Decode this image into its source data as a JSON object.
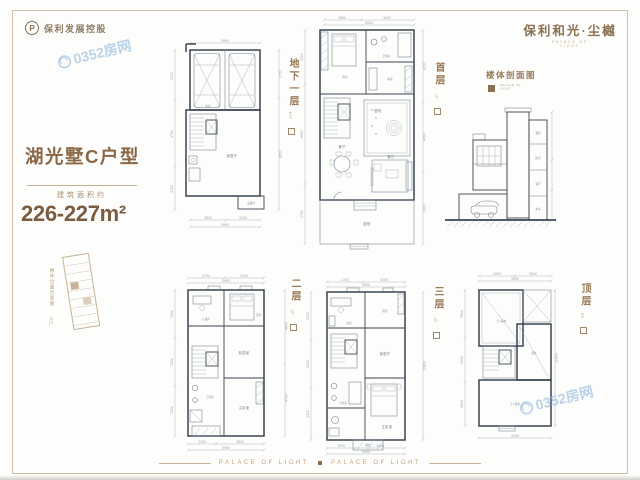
{
  "brand": {
    "logo_text": "保利发展控股",
    "logo_mark": "P",
    "name": "保利和光·尘樾",
    "name_sub": "PALACE OF LIGHT"
  },
  "unit": {
    "name": "湖光墅C户型",
    "area_label": "建筑面积约",
    "area_value": "226-227m²"
  },
  "locator": {
    "caption": "楼体位置示意图",
    "entry": "入户"
  },
  "watermark": {
    "text": "0352房网"
  },
  "footer": {
    "left": "PALACE OF LIGHT",
    "right": "PALACE OF LIGHT"
  },
  "section": {
    "label": "楼体剖面图",
    "sub1": "PALACE OF",
    "sub2": "LIGHT",
    "rooms": {
      "r1": "露台",
      "r2": "卧室",
      "r3": "客厅",
      "r4": "车库"
    }
  },
  "plans": {
    "b1": {
      "label": "地下一层",
      "tag": "B1F",
      "rooms": {
        "garage": "车库",
        "family": "家庭厅",
        "equip": "设备间"
      },
      "dims": {
        "top": "5900",
        "left1": "2150",
        "left2": "5750",
        "left3": "3300",
        "right1": "2150",
        "right2": "8850",
        "bottom1": "3650",
        "bottom2": "2250",
        "bottom": "5900"
      }
    },
    "f1": {
      "label": "首层",
      "tag": "1F",
      "rooms": {
        "bed": "卧室",
        "bath": "卫生间",
        "kitchen": "厨房",
        "court": "庭院",
        "dining": "餐厅",
        "living": "客厅",
        "yard": "庭院"
      },
      "dims": {
        "top1": "2600",
        "top2": "3400",
        "top": "6000",
        "left1": "3300",
        "left2": "6900",
        "left3": "2700",
        "right1": "4100",
        "right2": "4000",
        "right3": "2900",
        "bottom": "6000"
      }
    },
    "f2": {
      "label": "二层",
      "tag": "2F",
      "rooms": {
        "kid": "儿童房",
        "bed": "卧室",
        "sitting": "起居室",
        "master": "主卧室",
        "bath": "卫生间"
      },
      "dims": {
        "top1": "2750",
        "top2": "3150",
        "top": "5900",
        "left1": "2900",
        "left2": "3300",
        "left3": "3000",
        "right1": "4600",
        "right2": "4700",
        "bottom1": "2100",
        "bottom2": "3800",
        "bottom": "5900"
      }
    },
    "f3": {
      "label": "三层",
      "tag": "3F",
      "rooms": {
        "study": "书房",
        "bed": "卧室",
        "family": "家庭厅",
        "master": "主卧室",
        "bath": "卫生间",
        "terrace": "露台"
      },
      "dims": {
        "top1": "2700",
        "top2": "3200",
        "top": "5900",
        "left1": "3300",
        "left2": "4200",
        "left3": "3300",
        "right": "10800",
        "bottom1": "1950",
        "bottom2": "3950",
        "bottom": "5900"
      }
    },
    "rf": {
      "label": "顶层",
      "tag": "RF",
      "rooms": {
        "t1": "上人露台",
        "t2": "露台",
        "t3": "上人露台"
      },
      "dims": {
        "top1": "2900",
        "top2": "3000",
        "top": "5900",
        "left1": "3900",
        "left2": "3300",
        "left3": "3600",
        "right": "10800",
        "bottom": "5900"
      }
    }
  }
}
